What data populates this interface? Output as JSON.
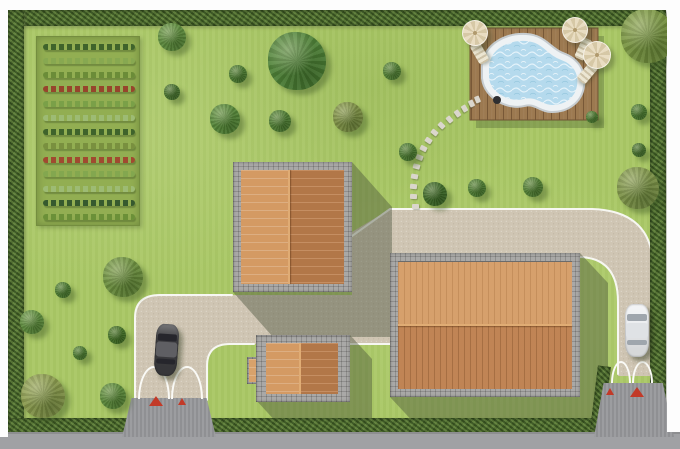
{
  "meta": {
    "description": "Top-down landscape site plan: lawn with hedge border, vegetable garden, kidney pool on wood deck, three tiled-roof buildings, paved driveways with two gates and two cars"
  },
  "scene": {
    "colors": {
      "lawn": "#a9c765",
      "hedge": "#5b7b3b",
      "hedge-dark": "#46622c",
      "garden-bg": "#92ae52",
      "drive": "#cfc5b3",
      "curb": "#f7f7f2",
      "road": "#a0a1a4",
      "apron": "#97989b",
      "stone-border": "#a3a2a0",
      "roof-light": "#d49a63",
      "roof-dark": "#bd7e4c",
      "deck": "#9c7950",
      "water": "#b5daed",
      "pool-rim": "#eef2f4",
      "pool-ring": "#c6ccd0",
      "umbrella": "#e9ddc2",
      "umbrella-dark": "#d6c8a6",
      "triangle": "#c23a28",
      "shadow": "rgba(70,78,55,0.42)"
    },
    "garden": {
      "rows": [
        "#3f632b",
        "#87a851",
        "#6b8c38",
        "#96452c",
        "#7aa048",
        "#9dbb74",
        "#3f632b",
        "#79903f",
        "#a04a30",
        "#83a74f",
        "#9dbb74",
        "#36592e",
        "#6b9038"
      ]
    },
    "trees": [
      {
        "x": 172,
        "y": 37,
        "r": 14,
        "c": "#5e8c3e"
      },
      {
        "x": 297,
        "y": 61,
        "r": 29,
        "c": "#4f8238"
      },
      {
        "x": 238,
        "y": 74,
        "r": 9,
        "c": "#4c7a32"
      },
      {
        "x": 225,
        "y": 119,
        "r": 15,
        "c": "#57883a"
      },
      {
        "x": 280,
        "y": 121,
        "r": 11,
        "c": "#4f7d34"
      },
      {
        "x": 348,
        "y": 117,
        "r": 15,
        "c": "#7d8f45"
      },
      {
        "x": 392,
        "y": 71,
        "r": 9,
        "c": "#527f36"
      },
      {
        "x": 648,
        "y": 36,
        "r": 27,
        "c": "#7a9643"
      },
      {
        "x": 172,
        "y": 92,
        "r": 8,
        "c": "#487230"
      },
      {
        "x": 408,
        "y": 152,
        "r": 9,
        "c": "#4c7a32"
      },
      {
        "x": 435,
        "y": 194,
        "r": 12,
        "c": "#3f6a2a"
      },
      {
        "x": 477,
        "y": 188,
        "r": 9,
        "c": "#4f7d34"
      },
      {
        "x": 533,
        "y": 187,
        "r": 10,
        "c": "#538036"
      },
      {
        "x": 592,
        "y": 117,
        "r": 6,
        "c": "#4c7a32"
      },
      {
        "x": 639,
        "y": 112,
        "r": 8,
        "c": "#4c7a32"
      },
      {
        "x": 639,
        "y": 150,
        "r": 7,
        "c": "#487230"
      },
      {
        "x": 638,
        "y": 188,
        "r": 21,
        "c": "#7e9449"
      },
      {
        "x": 123,
        "y": 277,
        "r": 20,
        "c": "#6d9040"
      },
      {
        "x": 63,
        "y": 290,
        "r": 8,
        "c": "#4c7a32"
      },
      {
        "x": 32,
        "y": 322,
        "r": 12,
        "c": "#5e8c3e"
      },
      {
        "x": 117,
        "y": 335,
        "r": 9,
        "c": "#447028"
      },
      {
        "x": 80,
        "y": 353,
        "r": 7,
        "c": "#4c7a32"
      },
      {
        "x": 43,
        "y": 396,
        "r": 22,
        "c": "#8a9a4e"
      },
      {
        "x": 113,
        "y": 396,
        "r": 13,
        "c": "#5c8a3c"
      }
    ],
    "stepping_stones": [
      {
        "x": 412,
        "y": 204,
        "a": 0
      },
      {
        "x": 410,
        "y": 194,
        "a": 2
      },
      {
        "x": 410,
        "y": 184,
        "a": 5
      },
      {
        "x": 411,
        "y": 174,
        "a": 10
      },
      {
        "x": 413,
        "y": 164,
        "a": 15
      },
      {
        "x": 416,
        "y": 155,
        "a": 20
      },
      {
        "x": 420,
        "y": 146,
        "a": 27
      },
      {
        "x": 425,
        "y": 138,
        "a": 33
      },
      {
        "x": 431,
        "y": 130,
        "a": 38
      },
      {
        "x": 438,
        "y": 123,
        "a": 44
      },
      {
        "x": 446,
        "y": 117,
        "a": 50
      },
      {
        "x": 454,
        "y": 111,
        "a": 55
      },
      {
        "x": 461,
        "y": 106,
        "a": 60
      },
      {
        "x": 468,
        "y": 101,
        "a": 64
      },
      {
        "x": 474,
        "y": 97,
        "a": 68
      }
    ],
    "umbrellas": [
      {
        "x": 475,
        "y": 33,
        "r": 13
      },
      {
        "x": 575,
        "y": 30,
        "r": 13
      },
      {
        "x": 597,
        "y": 55,
        "r": 14
      }
    ],
    "loungers": [
      {
        "x": 474,
        "y": 42,
        "a": -30
      },
      {
        "x": 578,
        "y": 38,
        "a": 25
      },
      {
        "x": 582,
        "y": 62,
        "a": 40
      }
    ],
    "cars": [
      {
        "name": "dark-car",
        "x": 155,
        "y": 324,
        "w": 23,
        "h": 52,
        "a": 4,
        "body": "#3d3d40",
        "roof": "#5f5f63",
        "glass": "#26262c"
      },
      {
        "name": "white-car",
        "x": 625,
        "y": 304,
        "w": 24,
        "h": 53,
        "a": 0,
        "body": "#eef0f2",
        "roof": "#dfe2e5",
        "glass": "#9fa6ad"
      }
    ],
    "gate_markers": [
      {
        "x": 149,
        "y": 396,
        "w": 14,
        "h": 10
      },
      {
        "x": 178,
        "y": 398,
        "w": 9,
        "h": 7
      },
      {
        "x": 606,
        "y": 388,
        "w": 9,
        "h": 7
      },
      {
        "x": 630,
        "y": 387,
        "w": 14,
        "h": 10
      }
    ]
  }
}
